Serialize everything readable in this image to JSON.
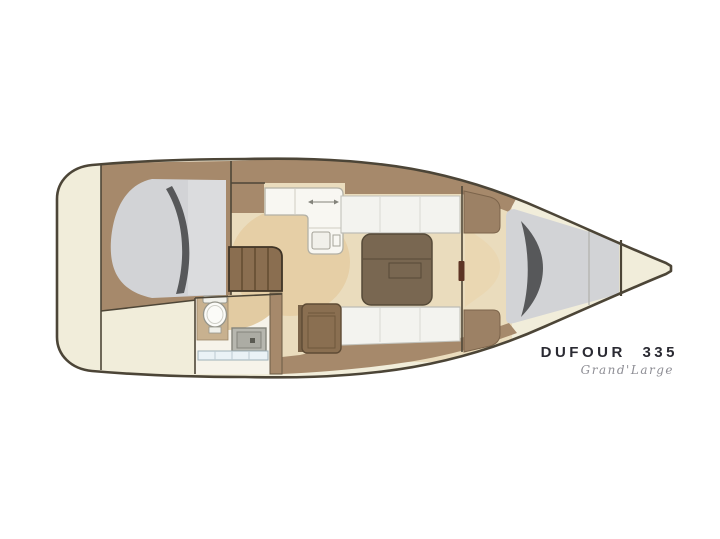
{
  "branding": {
    "name": "DUFOUR 335",
    "tagline": "Grand'Large"
  },
  "palette": {
    "background": "#ffffff",
    "hull_cream": "#f1edda",
    "outline": "#4c4537",
    "wood_trim": "#a6896b",
    "wood_block": "#9c8165",
    "wood_dark": "#8a6e50",
    "stair_wood": "#8a6e50",
    "floor_beige": "#eadcbd",
    "rug_tan": "#e6cfa6",
    "entry_tan": "#ead7b2",
    "berth_gray": "#d2d3d6",
    "berth_gray_light": "#dbdcde",
    "berth_shadow": "#57585a",
    "cushion_white": "#f3f3ef",
    "counter_white": "#f8f7f2",
    "table_brown": "#796751",
    "nav_brown": "#8a6f51",
    "head_floor": "#f6f3ea",
    "head_tan": "#e2cba2",
    "platform_tan": "#c8b18f",
    "sink_gray": "#b7b7af",
    "shelf_blue": "#eaf2f6",
    "door_mark": "#5d3424"
  },
  "regions": [
    "stern-platform",
    "aft-cabin-double-berth",
    "head-bathroom",
    "companionway-steps",
    "galley",
    "salon-settees",
    "salon-table",
    "nav-cabinet",
    "forward-wardrobes",
    "v-berth-cabin",
    "anchor-locker"
  ]
}
